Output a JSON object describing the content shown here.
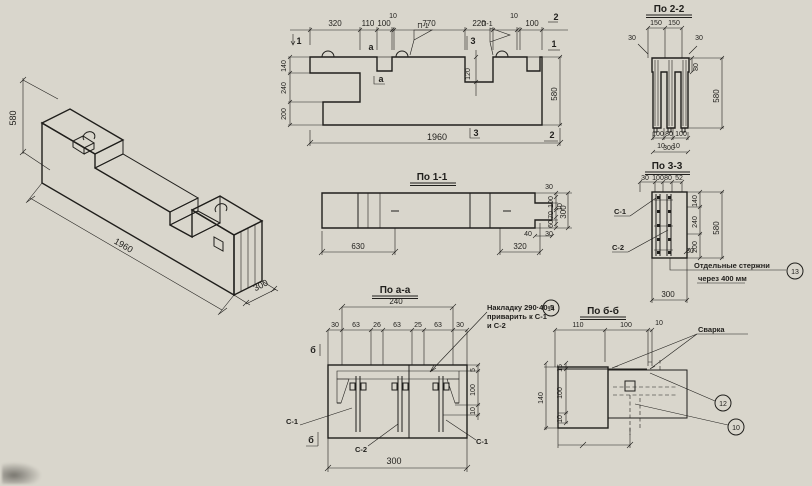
{
  "drawing": {
    "paper_color": "#d9d6cc",
    "ink_color": "#201f1c",
    "views": {
      "isometric": {
        "dim_height": "580",
        "dim_length": "1960",
        "dim_width": "300"
      },
      "elevation": {
        "top_dims": [
          "320",
          "110",
          "100",
          "10",
          "770",
          "220",
          "10",
          "100"
        ],
        "left_dims": [
          "140",
          "240",
          "200"
        ],
        "right_dim": "580",
        "bottom_dim": "1960",
        "recess_dim": "120",
        "flags": [
          "П-1",
          "П-1"
        ],
        "marks": {
          "one_left": "1",
          "two_top": "2",
          "one_right": "1",
          "two_bottom": "2",
          "three_top": "3",
          "three_bottom": "3",
          "a_top": "а",
          "a_bottom": "а"
        }
      },
      "section_1_1": {
        "title": "По 1-1",
        "bottom_dims": [
          "630",
          "320",
          "40"
        ],
        "width_dims": [
          "30",
          "100",
          "10",
          "70",
          "60",
          "30"
        ],
        "width_total": "300"
      },
      "section_2_2": {
        "title": "По 2-2",
        "top_dims": [
          "150",
          "150"
        ],
        "left_small": "30",
        "right_small": "30",
        "dim_80": "80",
        "height_dim": "580",
        "bottom_dims": [
          "100",
          "80",
          "100"
        ],
        "bottom_tens": [
          "10",
          "10"
        ],
        "bottom_total": "300"
      },
      "section_3_3": {
        "title": "По 3-3",
        "top_dims": [
          "30",
          "100",
          "80",
          "52"
        ],
        "labels": [
          "С-1",
          "С-2"
        ],
        "right_dims": [
          "140",
          "240",
          "200"
        ],
        "small_dim": "30",
        "height_dim": "580",
        "bottom_dim": "300",
        "note1": "Отдельные стержни",
        "note2": "через 400 мм",
        "pos": "13"
      },
      "section_a_a": {
        "title": "По а-а",
        "span_dim": "240",
        "row_dims": [
          "30",
          "63",
          "26",
          "63",
          "25",
          "63",
          "30"
        ],
        "labels": [
          "С-1",
          "С-2",
          "С-1"
        ],
        "cut_top": "б",
        "cut_bottom": "б",
        "right_dims": [
          "5",
          "100",
          "10"
        ],
        "bottom_dim": "300",
        "note1": "Накладку 290·40-5",
        "note2": "приварить к С-1",
        "note3": "и С-2",
        "pos": "14"
      },
      "section_b_b": {
        "title": "По б-б",
        "top_dims": [
          "110",
          "100",
          "10"
        ],
        "left_dims": [
          "15",
          "100",
          "10"
        ],
        "left_total": "140",
        "weld_label": "Сварка",
        "pos_plate": "12",
        "pos_loop": "10"
      }
    }
  }
}
